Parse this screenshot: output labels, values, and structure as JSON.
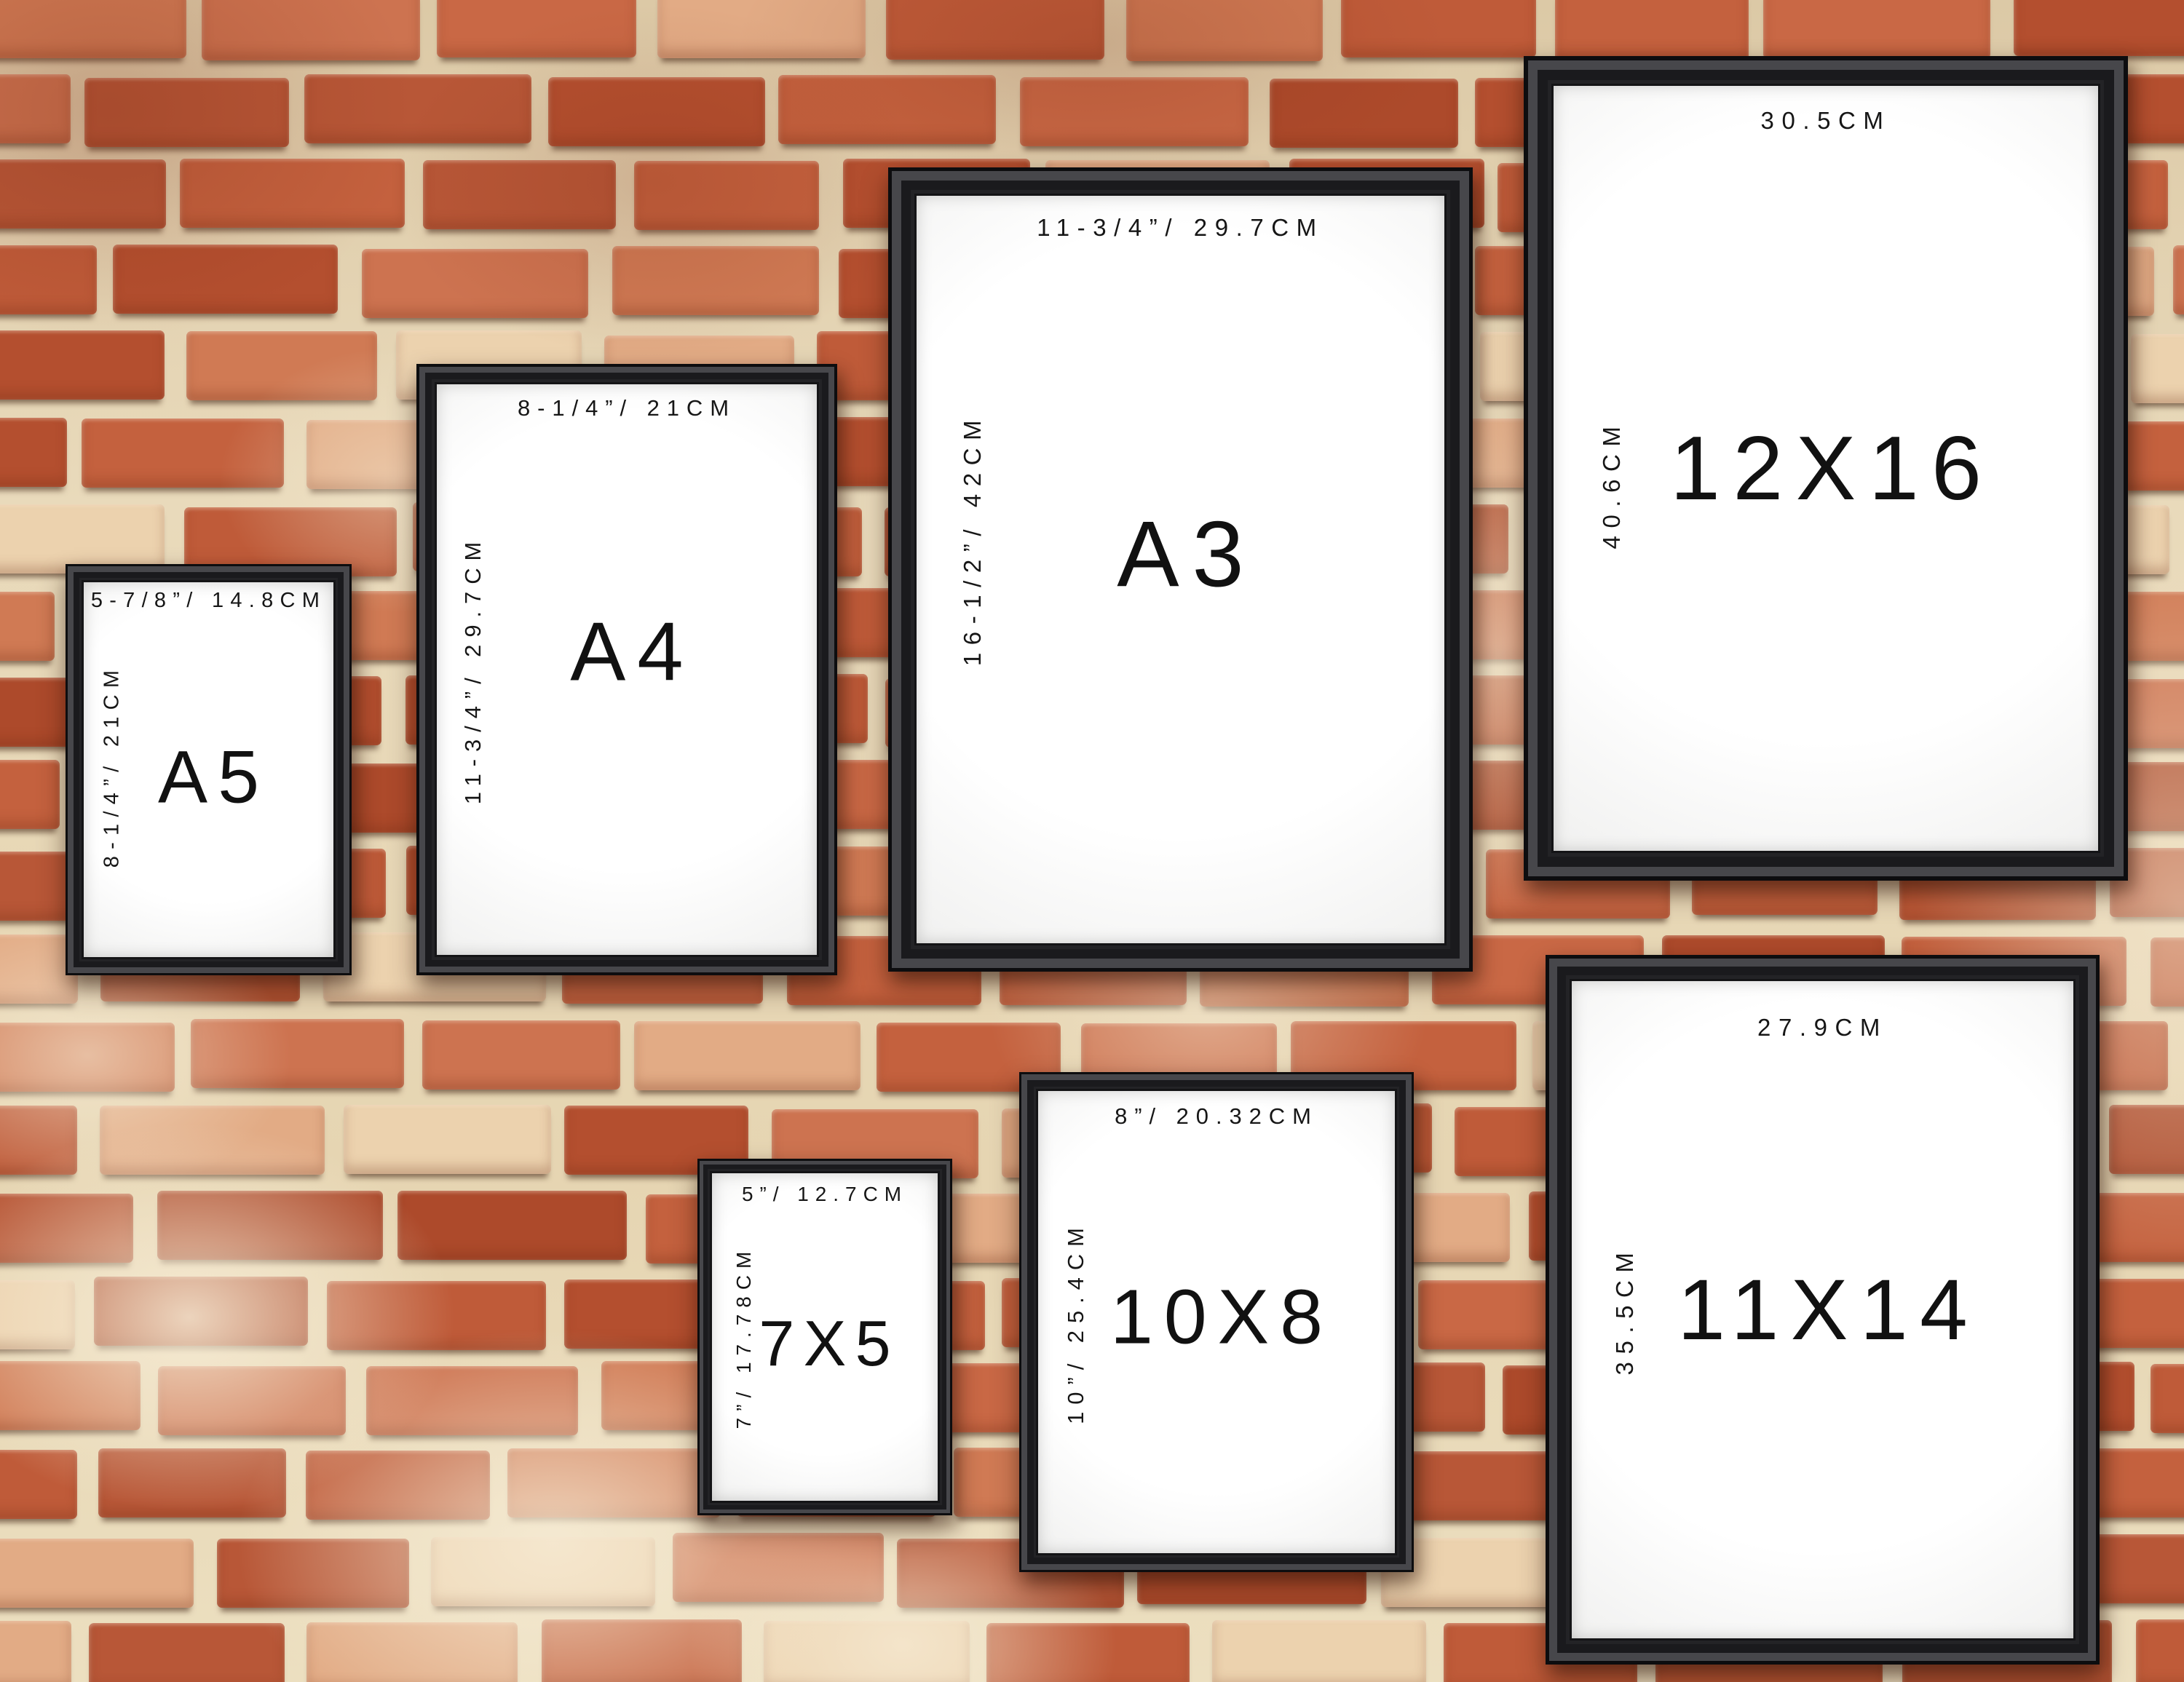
{
  "page": {
    "description": "Wall art frame size comparison — seven black picture frames hanging on a red brick wall, each labelled with its print size"
  },
  "wall": {
    "mortar_color": "#e7d8b8",
    "brick_palette": [
      "#bf5b39",
      "#c96845",
      "#b44f2f",
      "#cd7350",
      "#b85737",
      "#c4613e",
      "#d07a54",
      "#ad4a2b"
    ],
    "brick_light_accents": [
      "#e2ab85",
      "#ecd2ae"
    ],
    "shadow_color": "#33190d",
    "highlight_color": "#f7ecd6"
  },
  "frame_style": {
    "frame_color": "#232326",
    "mat_color": "#ffffff",
    "label_color": "#161616"
  },
  "frames": [
    {
      "id": "a5",
      "name": "A5",
      "width_label": "5-7/8”/ 14.8CM",
      "height_label": "8-1/4”/ 21CM"
    },
    {
      "id": "a4",
      "name": "A4",
      "width_label": "8-1/4”/ 21CM",
      "height_label": "11-3/4”/ 29.7CM"
    },
    {
      "id": "a3",
      "name": "A3",
      "width_label": "11-3/4”/ 29.7CM",
      "height_label": "16-1/2”/ 42CM"
    },
    {
      "id": "12x16",
      "name": "12X16",
      "width_label": "30.5CM",
      "height_label": "40.6CM"
    },
    {
      "id": "7x5",
      "name": "7X5",
      "width_label": "5”/ 12.7CM",
      "height_label": "7”/ 17.78CM"
    },
    {
      "id": "10x8",
      "name": "10X8",
      "width_label": "8”/ 20.32CM",
      "height_label": "10”/ 25.4CM"
    },
    {
      "id": "11x14",
      "name": "11X14",
      "width_label": "27.9CM",
      "height_label": "35.5CM"
    }
  ]
}
